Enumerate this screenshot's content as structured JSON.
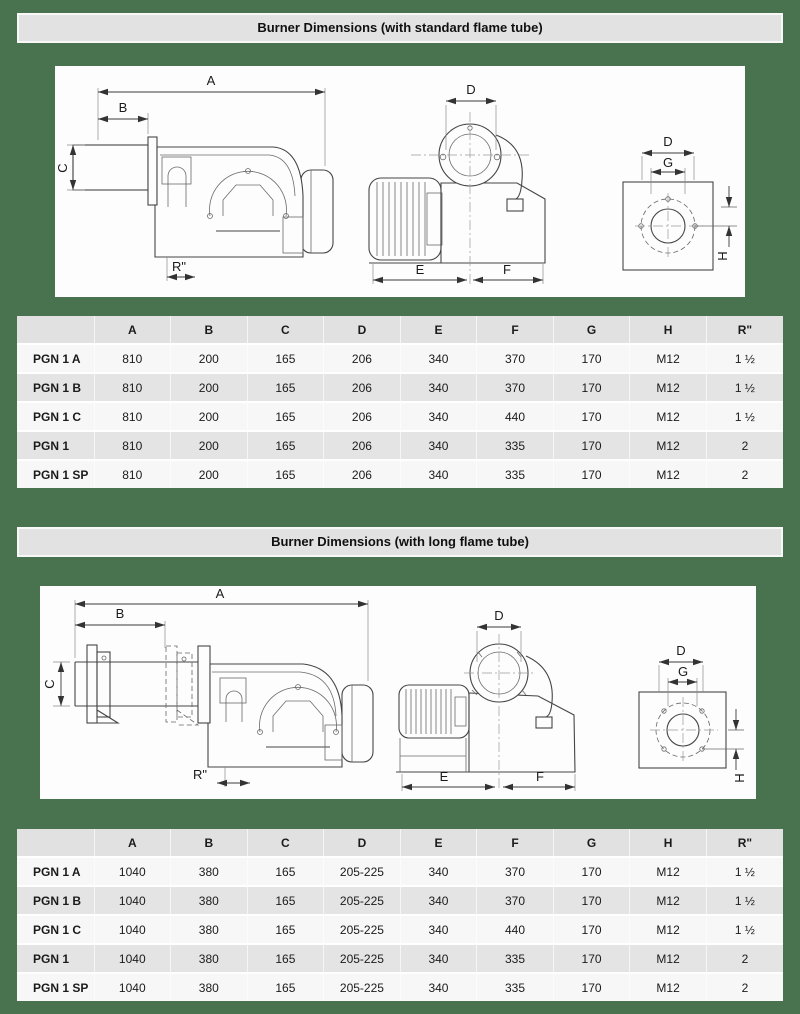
{
  "page": {
    "background_color": "#49724e",
    "panel_color": "#fdfdfd",
    "bar_color": "#e2e2e2"
  },
  "sections": [
    {
      "title": "Burner Dimensions (with standard flame tube)",
      "labels": {
        "A": "A",
        "B": "B",
        "C": "C",
        "D": "D",
        "E": "E",
        "F": "F",
        "G": "G",
        "H": "H",
        "R": "R\""
      },
      "table": {
        "headers": [
          "",
          "A",
          "B",
          "C",
          "D",
          "E",
          "F",
          "G",
          "H",
          "R\""
        ],
        "rows": [
          {
            "name": "PGN 1 A",
            "values": [
              "810",
              "200",
              "165",
              "206",
              "340",
              "370",
              "170",
              "M12",
              "1 ½"
            ]
          },
          {
            "name": "PGN 1 B",
            "values": [
              "810",
              "200",
              "165",
              "206",
              "340",
              "370",
              "170",
              "M12",
              "1 ½"
            ]
          },
          {
            "name": "PGN 1 C",
            "values": [
              "810",
              "200",
              "165",
              "206",
              "340",
              "440",
              "170",
              "M12",
              "1 ½"
            ]
          },
          {
            "name": "PGN 1",
            "values": [
              "810",
              "200",
              "165",
              "206",
              "340",
              "335",
              "170",
              "M12",
              "2"
            ]
          },
          {
            "name": "PGN 1 SP",
            "values": [
              "810",
              "200",
              "165",
              "206",
              "340",
              "335",
              "170",
              "M12",
              "2"
            ]
          }
        ]
      }
    },
    {
      "title": "Burner Dimensions (with long flame tube)",
      "labels": {
        "A": "A",
        "B": "B",
        "C": "C",
        "D": "D",
        "E": "E",
        "F": "F",
        "G": "G",
        "H": "H",
        "R": "R\""
      },
      "table": {
        "headers": [
          "",
          "A",
          "B",
          "C",
          "D",
          "E",
          "F",
          "G",
          "H",
          "R\""
        ],
        "rows": [
          {
            "name": "PGN 1 A",
            "values": [
              "1040",
              "380",
              "165",
              "205-225",
              "340",
              "370",
              "170",
              "M12",
              "1 ½"
            ]
          },
          {
            "name": "PGN 1 B",
            "values": [
              "1040",
              "380",
              "165",
              "205-225",
              "340",
              "370",
              "170",
              "M12",
              "1 ½"
            ]
          },
          {
            "name": "PGN 1 C",
            "values": [
              "1040",
              "380",
              "165",
              "205-225",
              "340",
              "440",
              "170",
              "M12",
              "1 ½"
            ]
          },
          {
            "name": "PGN 1",
            "values": [
              "1040",
              "380",
              "165",
              "205-225",
              "340",
              "335",
              "170",
              "M12",
              "2"
            ]
          },
          {
            "name": "PGN 1 SP",
            "values": [
              "1040",
              "380",
              "165",
              "205-225",
              "340",
              "335",
              "170",
              "M12",
              "2"
            ]
          }
        ]
      }
    }
  ]
}
